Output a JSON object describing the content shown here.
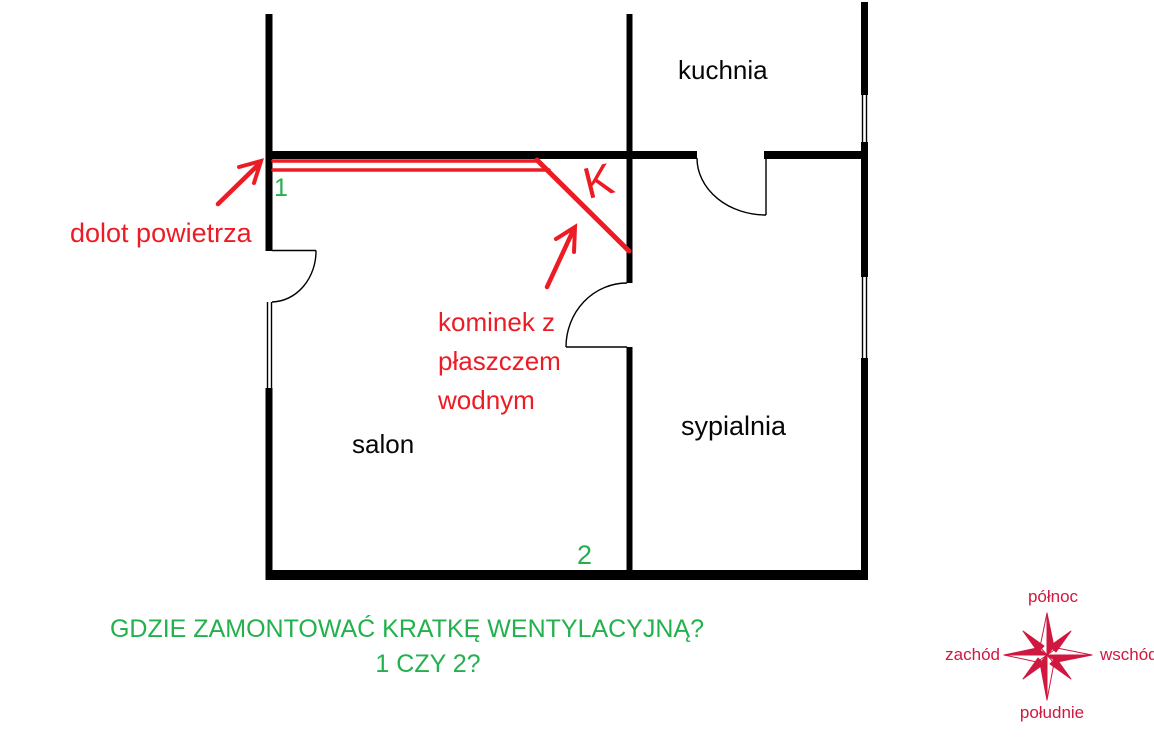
{
  "diagram": {
    "type": "floor-plan-sketch",
    "rooms": [
      {
        "id": "kuchnia",
        "label": "kuchnia"
      },
      {
        "id": "salon",
        "label": "salon"
      },
      {
        "id": "sypialnia",
        "label": "sypialnia"
      }
    ],
    "annotations": {
      "air_inlet_label": "dolot powietrza",
      "fireplace_label": "kominek z\npłaszczem\nwodnym",
      "fireplace_symbol": "K",
      "marker_1": "1",
      "marker_2": "2"
    },
    "question": {
      "line1": "GDZIE ZAMONTOWAĆ KRATKĘ WENTYLACYJNĄ?",
      "line2": "1 CZY 2?"
    },
    "compass": {
      "north": "północ",
      "south": "południe",
      "west": "zachód",
      "east": "wschód"
    },
    "colors": {
      "wall_black": "#000000",
      "annotation_red": "#ed1c24",
      "marker_green": "#22b14c",
      "compass_red": "#d0173f",
      "background": "#ffffff"
    }
  }
}
